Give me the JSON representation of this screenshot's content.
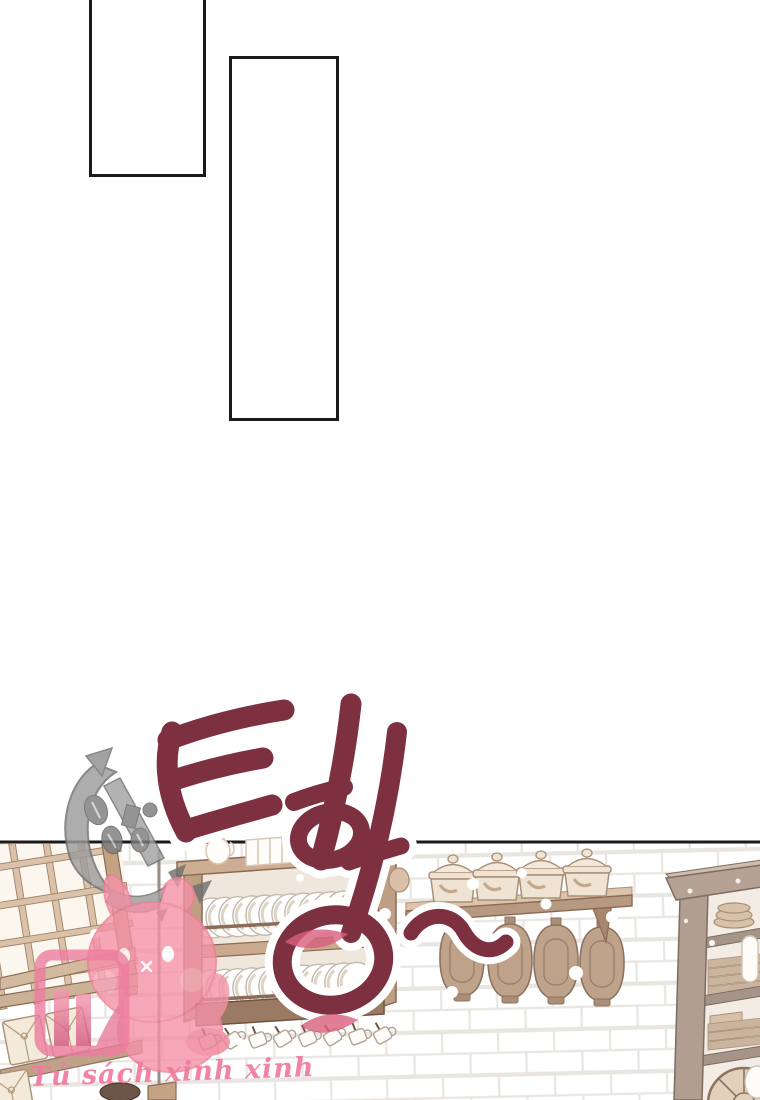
{
  "page": {
    "kind": "webtoon page",
    "background": "#ffffff",
    "panel_border_color": "#1b1b1b"
  },
  "sfx": {
    "text": "터엉",
    "squiggle": "~",
    "color": "#7d3140",
    "outline_color": "#ffffff"
  },
  "watermarks": {
    "credit_text": "Tủ sách xinh xinh",
    "credit_color": "#f0799e",
    "anchor_emblem": "gray-anchor-logo",
    "mascot": "pink-bunny-mascot",
    "badge": "pink-bookshelf-badge"
  },
  "scene": {
    "label": "kitchen wall with dish hutch, pot shelf and cabinets",
    "items": [
      "lattice-window",
      "package-shelf",
      "plate-rack-hutch",
      "hanging-cups",
      "pot-wall-shelf",
      "hanging-jars",
      "open-cabinet",
      "wicker-basket"
    ],
    "colors": {
      "wood_light": "#d9c2a9",
      "wood_mid": "#b79881",
      "wood_dark": "#8a6a55",
      "cream": "#efe3d4",
      "jar": "#bfa28a",
      "brick_line": "#e9e6e2",
      "plate_white": "#ffffff",
      "watermark_gray": "#9c9c9c",
      "watermark_pink": "#f492a7"
    }
  }
}
